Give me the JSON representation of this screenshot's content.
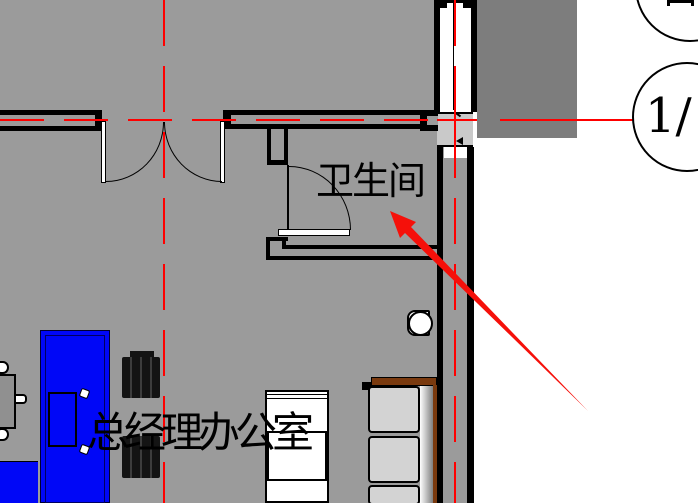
{
  "plan": {
    "labels": {
      "bathroom": "卫生间",
      "office": "总经理办公室"
    },
    "callout": {
      "lower_text": "1/"
    },
    "colors": {
      "floor": "#9b9b9b",
      "exterior_area": "#7d7d7d",
      "column_fill": "#c9c9c9",
      "wall": "#000000",
      "centerline": "#ff0000",
      "annotation_arrow": "#f5100a",
      "furniture_blue": "#0007f7",
      "cabinet_wood": "#7a3a0f",
      "cabinet_panel": "#d3d3d3",
      "chair_dark": "#141414"
    }
  }
}
